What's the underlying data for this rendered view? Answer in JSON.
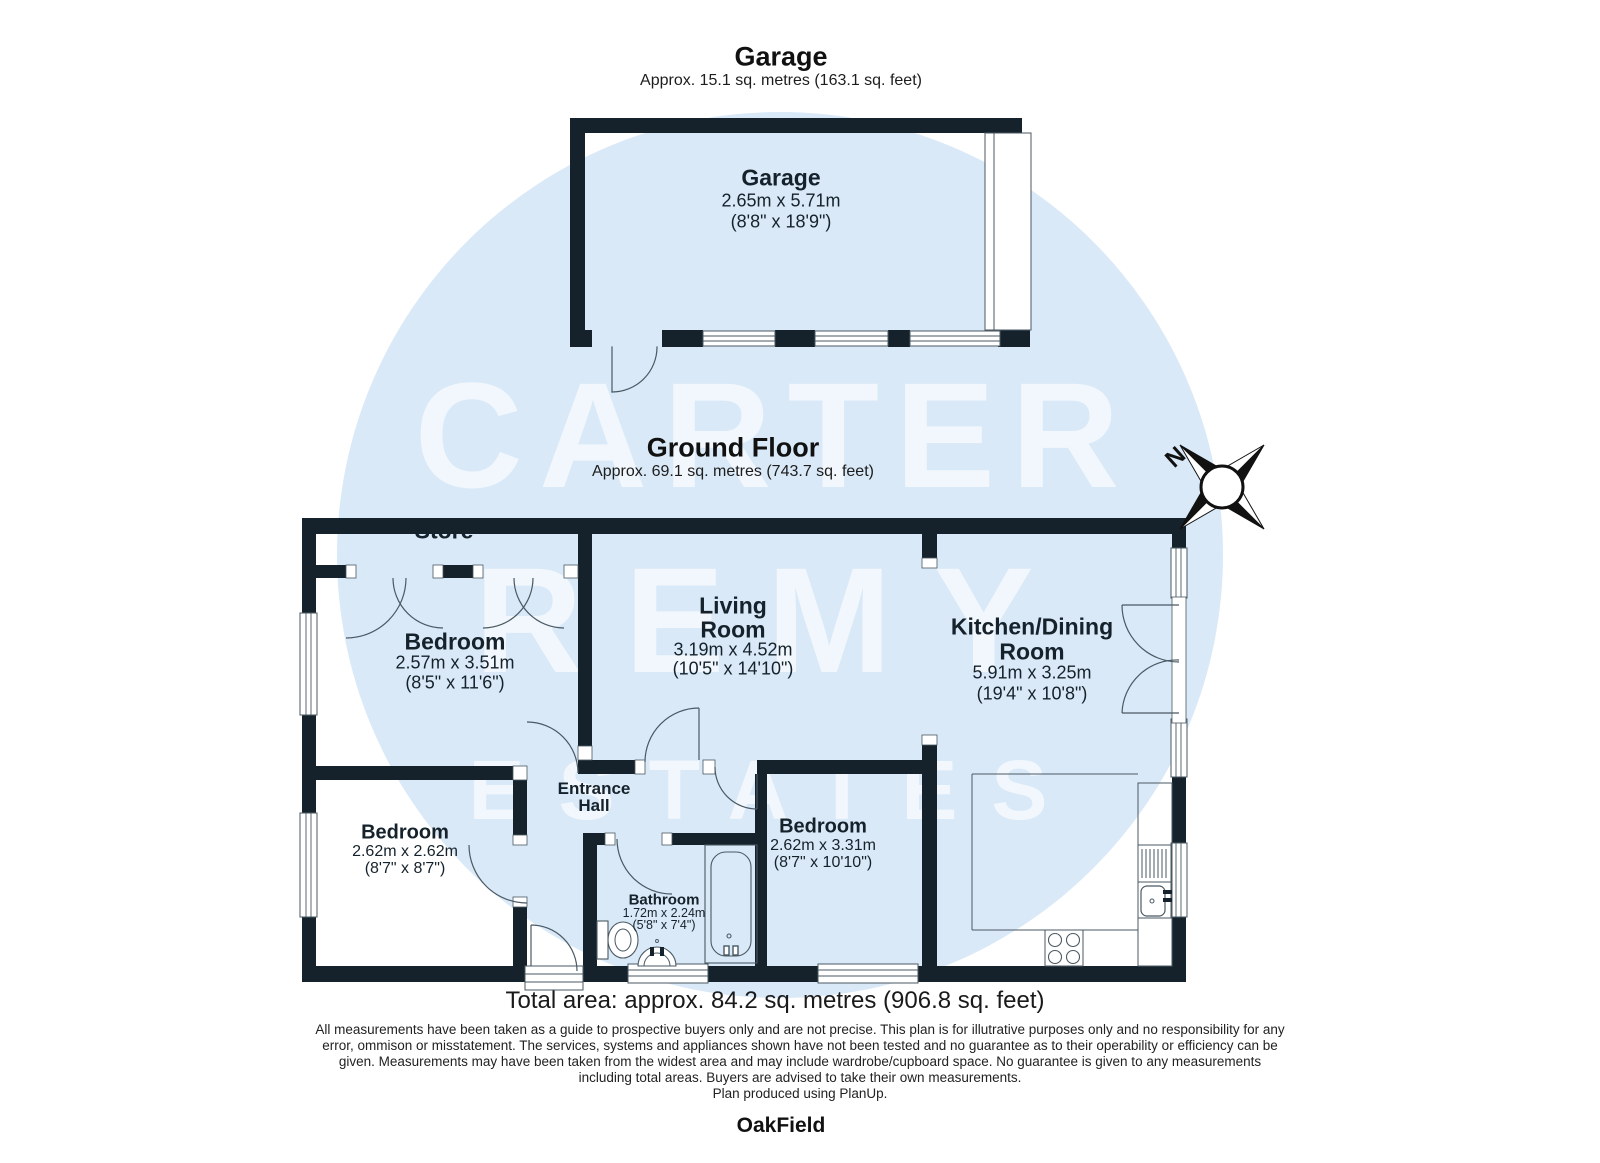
{
  "watermark": {
    "line1": "CARTER",
    "line2": "REMY",
    "line3": "ESTATES"
  },
  "colors": {
    "wall": "#15222b",
    "watermark_circle": "#d9e9f7",
    "plan_line": "#4a5963"
  },
  "garage_section": {
    "title": "Garage",
    "area": "Approx. 15.1 sq. metres (163.1 sq. feet)",
    "room": {
      "name": "Garage",
      "dims_m": "2.65m x 5.71m",
      "dims_ft": "(8'8\" x 18'9\")"
    }
  },
  "ground_floor_section": {
    "title": "Ground Floor",
    "area": "Approx. 69.1 sq. metres (743.7 sq. feet)",
    "compass_label": "N",
    "rooms": {
      "store": {
        "name": "Store"
      },
      "bedroom_top": {
        "name": "Bedroom",
        "dims_m": "2.57m x 3.51m",
        "dims_ft": "(8'5\" x 11'6\")"
      },
      "living": {
        "name_line1": "Living",
        "name_line2": "Room",
        "dims_m": "3.19m x 4.52m",
        "dims_ft": "(10'5\" x 14'10\")"
      },
      "kitchen": {
        "name_line1": "Kitchen/Dining",
        "name_line2": "Room",
        "dims_m": "5.91m x 3.25m",
        "dims_ft": "(19'4\" x 10'8\")"
      },
      "bedroom_left": {
        "name": "Bedroom",
        "dims_m": "2.62m x 2.62m",
        "dims_ft": "(8'7\" x 8'7\")"
      },
      "hall": {
        "name_line1": "Entrance",
        "name_line2": "Hall"
      },
      "bedroom_mid": {
        "name": "Bedroom",
        "dims_m": "2.62m x 3.31m",
        "dims_ft": "(8'7\" x 10'10\")"
      },
      "bathroom": {
        "name": "Bathroom",
        "dims_m": "1.72m x 2.24m",
        "dims_ft": "(5'8\" x 7'4\")"
      }
    }
  },
  "footer": {
    "total_area": "Total area: approx. 84.2 sq. metres (906.8 sq. feet)",
    "disclaimer": [
      "All measurements have been taken as a guide to prospective buyers only and are not precise. This plan is for illutrative purposes only and no responsibility for any",
      "error, ommison or misstatement. The services, systems and appliances shown have not been tested and no guarantee as to their operability or efficiency can be",
      "given. Measurements may have been taken from the widest area and may include wardrobe/cupboard space. No guarantee is given to any measurements",
      "including total areas. Buyers are advised to take their own measurements.",
      "Plan produced using PlanUp."
    ],
    "brand": "OakField"
  }
}
